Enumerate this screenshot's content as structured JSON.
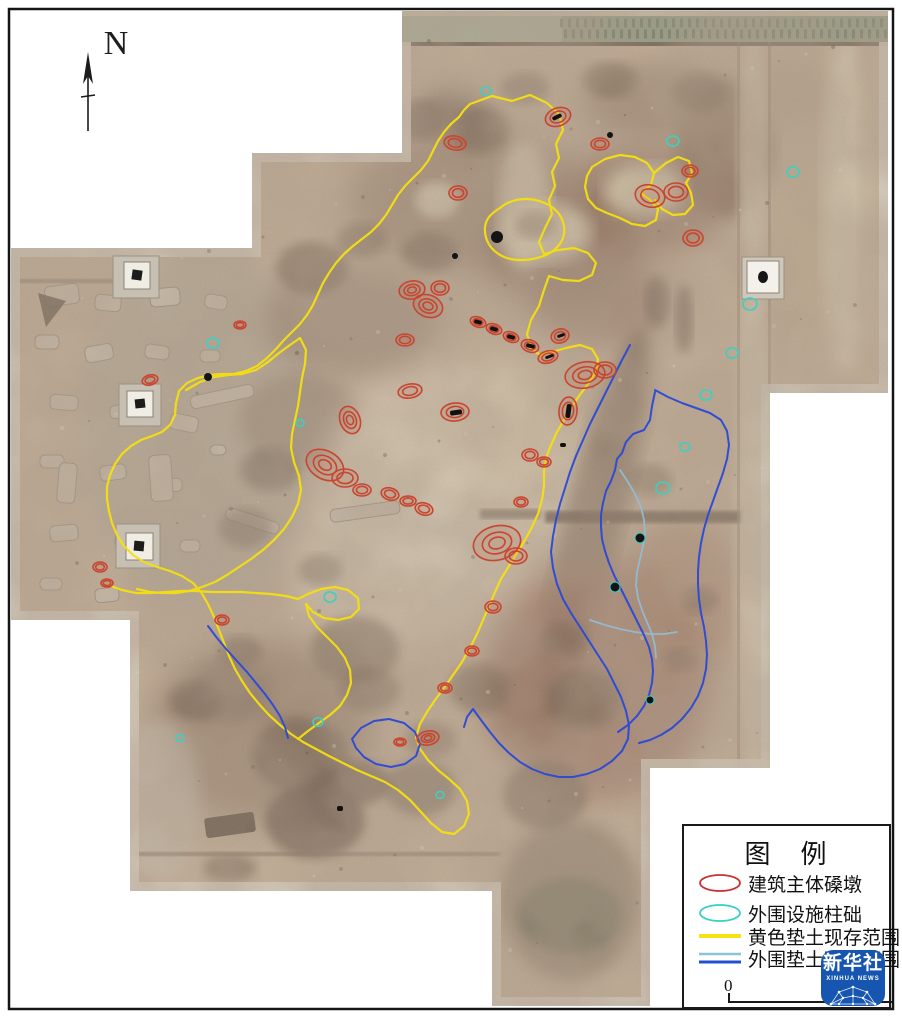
{
  "compass": {
    "label": "N"
  },
  "legend": {
    "title": "图　例",
    "items": [
      {
        "label": "建筑主体磉墩",
        "swatch": "ellipse",
        "color": "#cf2e2e"
      },
      {
        "label": "外围设施柱础",
        "swatch": "ellipse",
        "color": "#35d1c2"
      },
      {
        "label": "黄色垫土现存范围",
        "swatch": "line",
        "color": "#f8e112"
      },
      {
        "label": "外围垫土现存范围",
        "swatch": "double-line",
        "color": "#2150d2",
        "color2": "#8fc3dc"
      }
    ]
  },
  "scale_bar": {
    "zero_label": "0"
  },
  "watermark": {
    "name": "新华社",
    "subtitle": "XINHUA NEWS",
    "bg_color": "#1656b0"
  },
  "map_colors": {
    "yellow_outline": "#f5df10",
    "blue_outline": "#2b49d8",
    "light_blue_outline": "#93bdd6",
    "red_outline": "#c9452f",
    "cyan_outline": "#3ecfc0"
  }
}
